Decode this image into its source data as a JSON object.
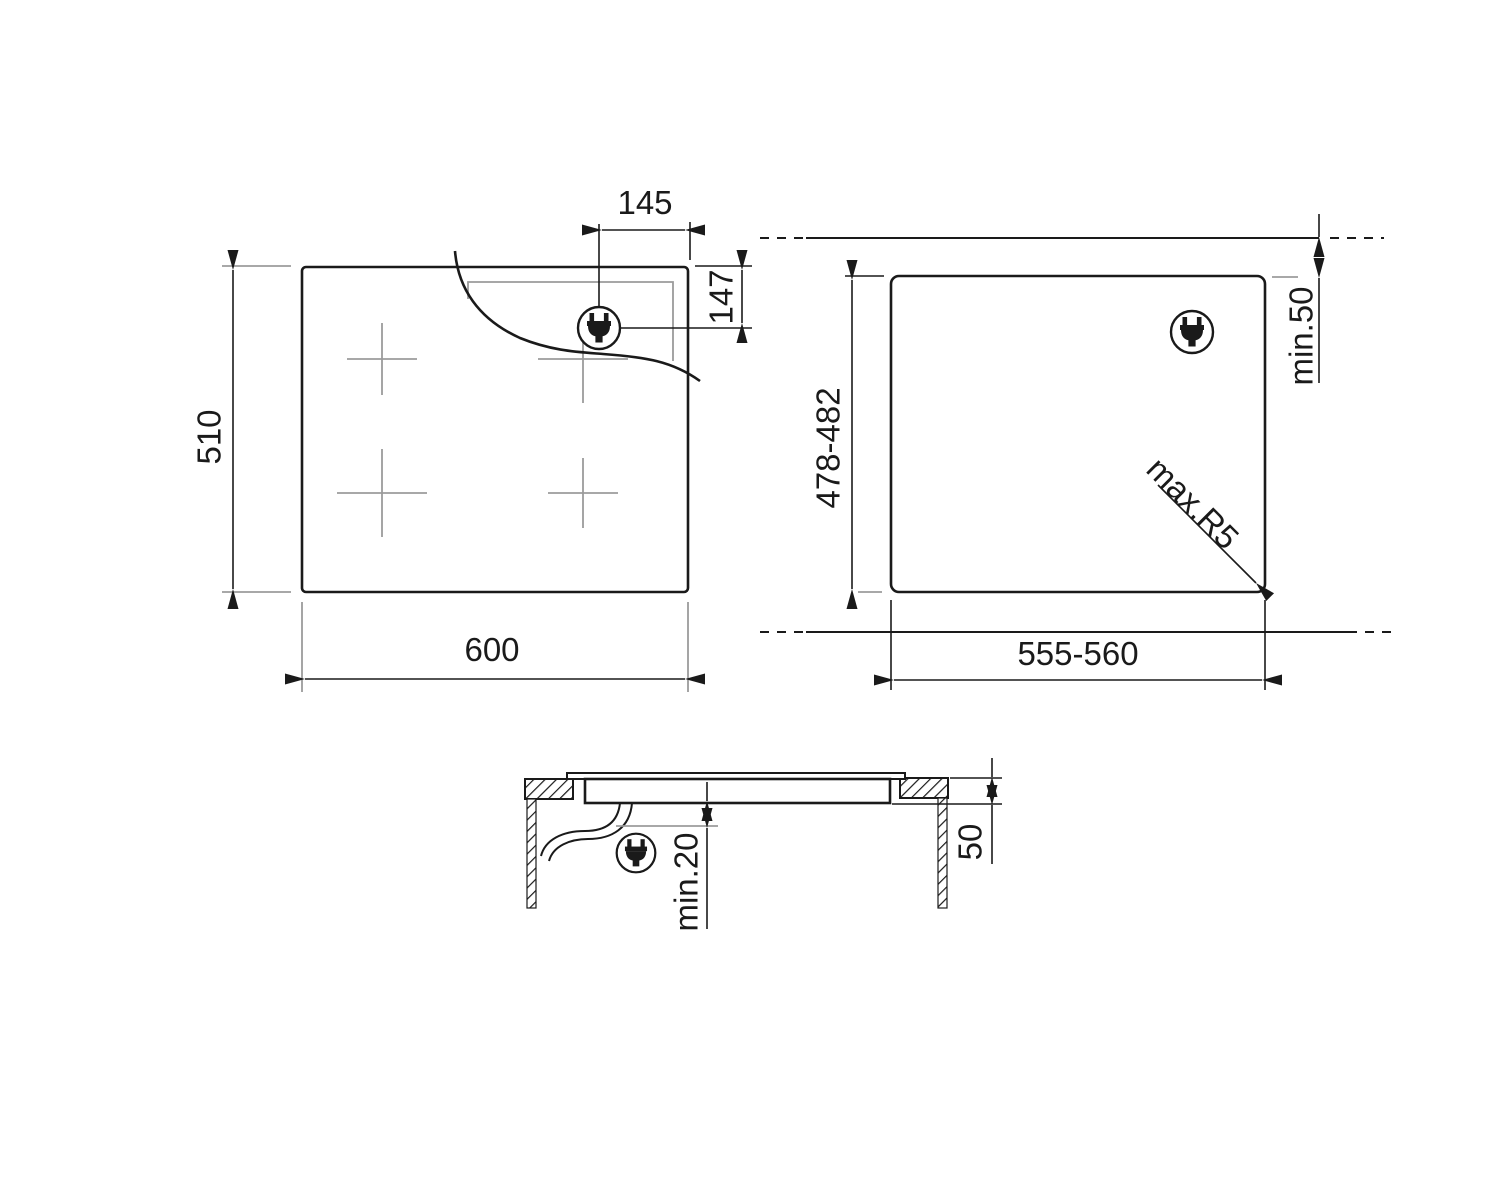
{
  "diagram_type": "appliance-installation-dimension-drawing",
  "labels": {
    "plan": {
      "width": "600",
      "depth": "510",
      "plug_from_right": "145",
      "plug_from_top": "147"
    },
    "cutout": {
      "width": "555-560",
      "depth": "478-482",
      "rear_clearance": "min.50",
      "corner_radius": "max.R5"
    },
    "section": {
      "clearance_below": "min.20",
      "worktop_thickness": "50"
    }
  },
  "icons": {
    "plug": "power-plug-icon",
    "burner": "burner-center-cross"
  },
  "colors": {
    "line": "#1a1a1a",
    "gray": "#9b9b9b",
    "background": "#ffffff"
  }
}
